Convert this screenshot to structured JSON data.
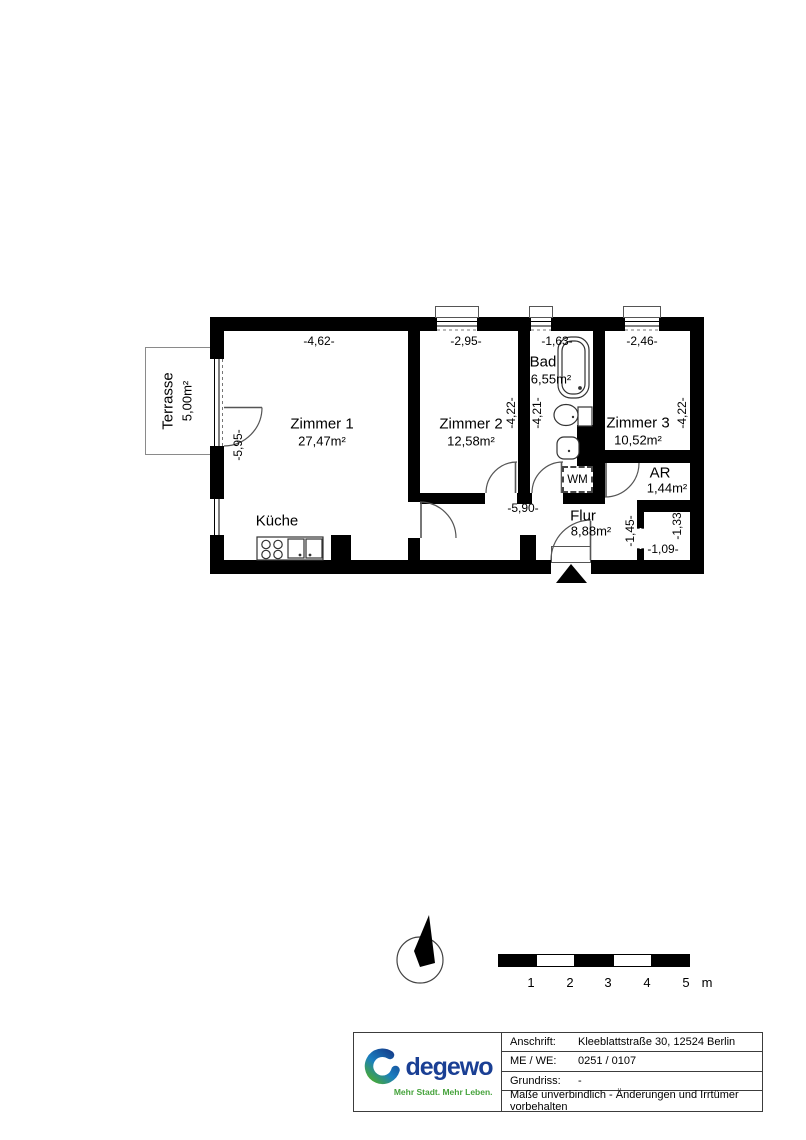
{
  "plan": {
    "rooms": {
      "zimmer1": {
        "name": "Zimmer 1",
        "area": "27,47m²"
      },
      "zimmer2": {
        "name": "Zimmer 2",
        "area": "12,58m²"
      },
      "zimmer3": {
        "name": "Zimmer 3",
        "area": "10,52m²"
      },
      "bad": {
        "name": "Bad",
        "area": "6,55m²"
      },
      "kueche": {
        "name": "Küche"
      },
      "flur": {
        "name": "Flur",
        "area": "8,88m²"
      },
      "ar": {
        "name": "AR",
        "area": "1,44m²"
      },
      "terrasse": {
        "name": "Terrasse",
        "area": "5,00m²"
      },
      "wm": {
        "name": "WM"
      }
    },
    "dimensions": {
      "zimmer1_width": "-4,62-",
      "zimmer2_width": "-2,95-",
      "bad_width": "-1,63-",
      "zimmer3_width": "-2,46-",
      "zimmer1_depth": "-5,95-",
      "zimmer2_depth": "-4,22-",
      "bad_depth": "-4,21-",
      "zimmer3_depth": "-4,22-",
      "flur_width": "-5,90-",
      "niche_height": "-1,45-",
      "niche_depth": "-1,33-",
      "niche_width": "-1,09-"
    }
  },
  "scale_bar": {
    "ticks": [
      "1",
      "2",
      "3",
      "4",
      "5"
    ],
    "unit": "m"
  },
  "title_block": {
    "rows": [
      {
        "label": "Anschrift:",
        "value": "Kleeblattstraße 30, 12524 Berlin"
      },
      {
        "label": "ME / WE:",
        "value": "0251 / 0107"
      },
      {
        "label": "Grundriss:",
        "value": "-"
      }
    ],
    "disclaimer": "Maße unverbindlich - Änderungen und Irrtümer vorbehalten"
  },
  "logo": {
    "brand": "degewo",
    "tagline": "Mehr Stadt. Mehr Leben.",
    "brand_color": "#1a3f94",
    "tagline_color": "#46a33c"
  }
}
